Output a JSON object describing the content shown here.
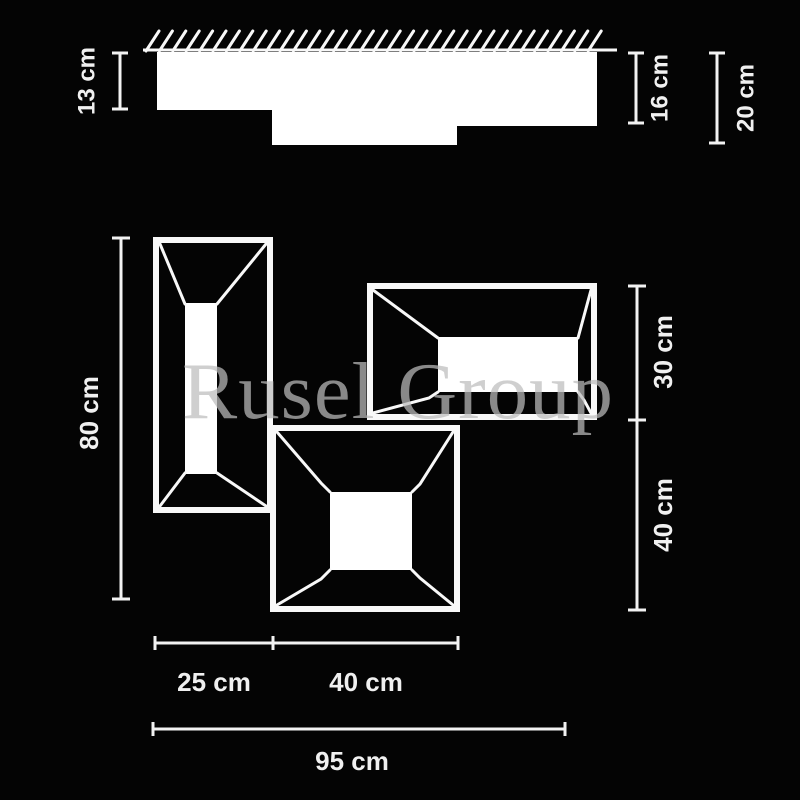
{
  "colors": {
    "background": "#040404",
    "line": "#f2f2f2",
    "panel_fill": "#ffffff",
    "watermark": "#bdbdbd"
  },
  "watermark": {
    "text": "Rusel Group"
  },
  "side_view": {
    "description": "ceiling-mount side profile",
    "dims": {
      "left_depth": "13 cm",
      "right_inner_depth": "16 cm",
      "right_outer_depth": "20 cm"
    }
  },
  "front_view": {
    "description": "three rectangular light panels",
    "dims": {
      "height_total": "80 cm",
      "right_upper": "30 cm",
      "right_lower": "40 cm",
      "bottom_left": "25 cm",
      "bottom_middle": "40 cm",
      "width_total": "95 cm"
    }
  }
}
